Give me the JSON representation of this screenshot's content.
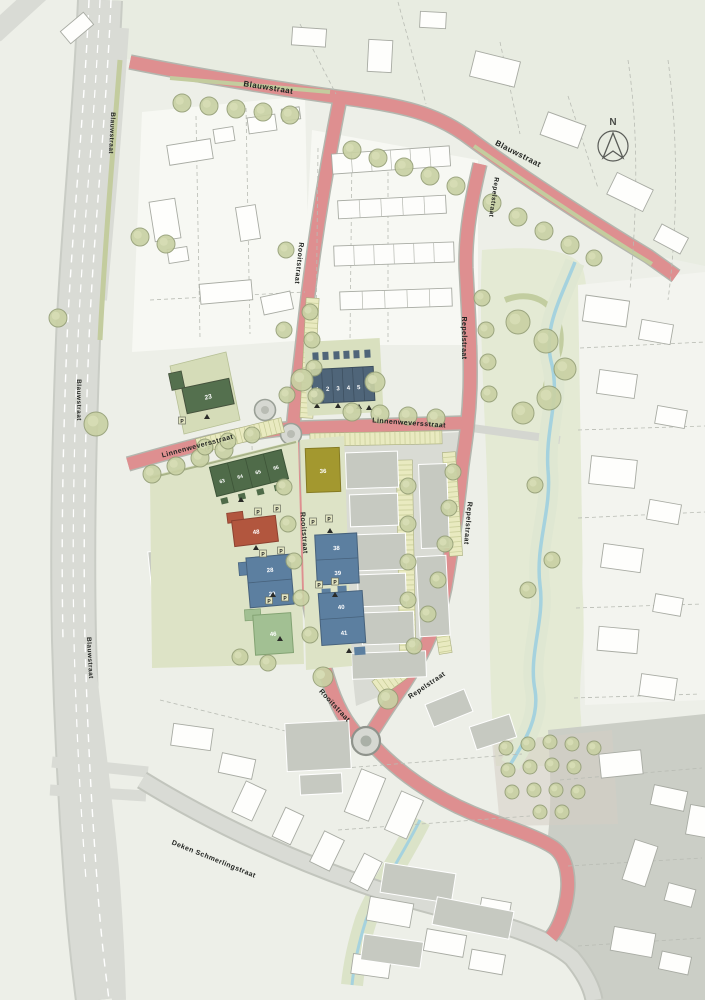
{
  "map": {
    "north_label": "N",
    "streets": {
      "blauwstraat": "Blauwstraat",
      "rooitstraat": "Rooitstraat",
      "repelstraat": "Repelstraat",
      "linnenweversstraat": "Linnenweversstraat",
      "deken_schmerlingstraat": "Deken Schmerlingstraat"
    },
    "plots": {
      "row_numbers": [
        "1",
        "2",
        "3",
        "4",
        "5",
        "6"
      ],
      "plot23": "23",
      "rowhouses": [
        "63",
        "64",
        "65",
        "66"
      ],
      "plot48": "48",
      "plot28": "28",
      "plot29": "29",
      "plot46": "46",
      "plot36": "36",
      "plot38": "38",
      "plot39": "39",
      "plot40": "40",
      "plot41": "41",
      "parking": "P"
    },
    "colors": {
      "background": "#edefe8",
      "north_area": "#e8ece1",
      "road_pink": "#de8f90",
      "road_grey": "#d9dbd5",
      "block_grey": "#d9dbd4",
      "building_grey": "#c6c9c1",
      "plot_green_light": "#dde3c6",
      "building_dark_green": "#54704e",
      "building_blue": "#5c7fa0",
      "rowhouse_blue": "#4f6579",
      "building_red": "#b2563e",
      "building_yellow": "#a3982f",
      "building_pale_green": "#a2c093",
      "tree_fill": "#c9d1a4",
      "stream_blue": "#a5d2de",
      "parking_yellow": "#e9eac0"
    }
  }
}
